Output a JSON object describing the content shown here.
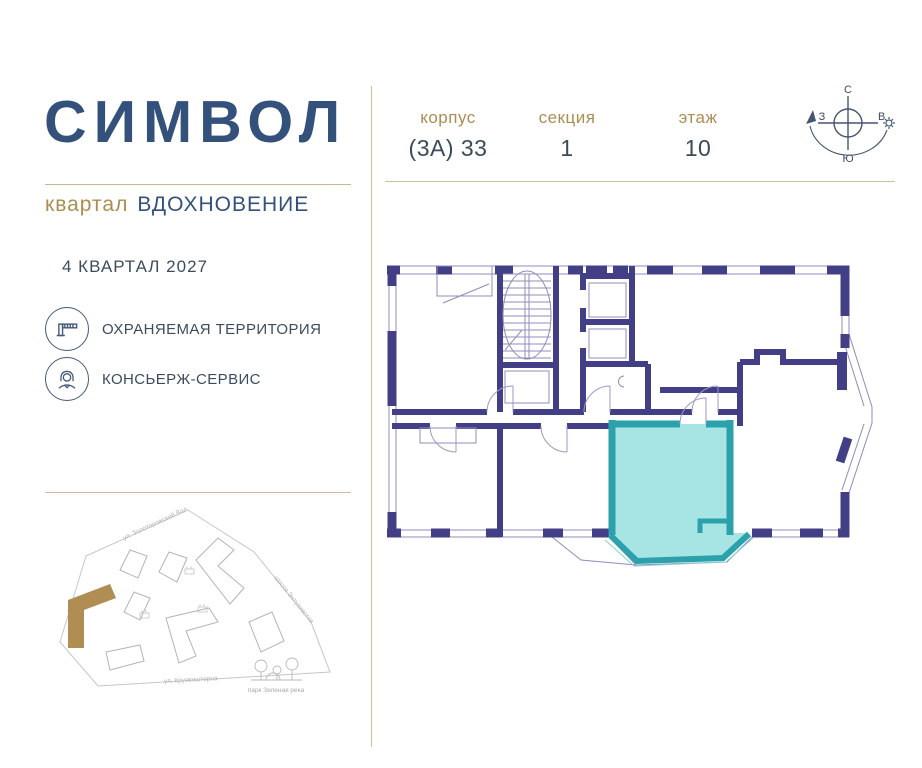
{
  "brand": {
    "title": "СИМВОЛ",
    "district_label": "квартал",
    "district_name": "ВДОХНОВЕНИЕ"
  },
  "completion": "4 КВАРТАЛ 2027",
  "features": [
    {
      "icon": "barrier-icon",
      "label": "ОХРАНЯЕМАЯ ТЕРРИТОРИЯ"
    },
    {
      "icon": "concierge-icon",
      "label": "КОНСЬЕРЖ-СЕРВИС"
    }
  ],
  "unit_info": {
    "fields": [
      {
        "label": "корпус",
        "value": "(3А) 33"
      },
      {
        "label": "секция",
        "value": "1"
      },
      {
        "label": "этаж",
        "value": "10"
      }
    ]
  },
  "compass": {
    "north": "С",
    "east": "В",
    "west": "З",
    "south": "Ю"
  },
  "site_map": {
    "street_top": "ул. Золоторожский Вал",
    "street_right": "шоссе Энтузиастов",
    "street_bottom": "ул. Крузенштерна",
    "park": "парк Зеленая река"
  },
  "colors": {
    "brand_navy": "#33517a",
    "accent_gold": "#ab8d52",
    "divider_gold": "#cdc09a",
    "wall_navy": "#433f86",
    "plan_thin_line": "#8f8cbc",
    "highlight_fill": "#9fe3e3",
    "highlight_stroke": "#2ba1ab",
    "site_highlight": "#b08d52"
  }
}
